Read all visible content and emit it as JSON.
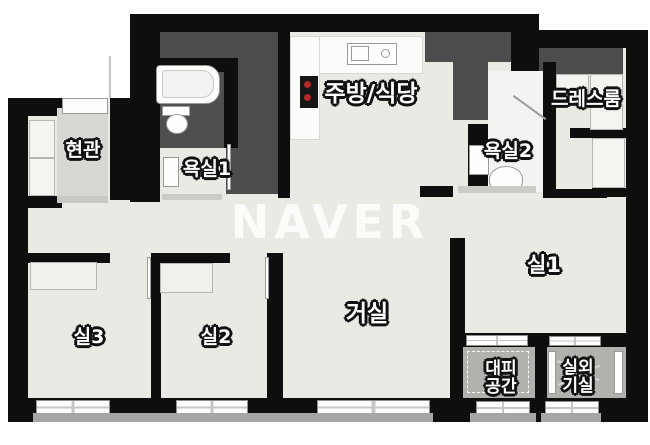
{
  "floorplan": {
    "watermark": "NAVER",
    "rooms": {
      "entrance": {
        "label": "현관"
      },
      "bath1": {
        "label": "욕실1"
      },
      "kitchen": {
        "label": "주방/식당"
      },
      "dressroom": {
        "label": "드레스룸"
      },
      "bath2": {
        "label": "욕실2"
      },
      "room1": {
        "label": "실1"
      },
      "living": {
        "label": "거실"
      },
      "room2": {
        "label": "실2"
      },
      "room3": {
        "label": "실3"
      },
      "evac": {
        "label": "대피 공간",
        "line1": "대피",
        "line2": "공간"
      },
      "outdoor": {
        "label": "실외 기실",
        "line1": "실외",
        "line2": "기실"
      }
    },
    "symbols": [
      "bathtub",
      "toilet",
      "washbasin",
      "kitchen-sink",
      "stove",
      "wardrobe",
      "shoe-closet",
      "window",
      "door"
    ],
    "colors": {
      "wall": "#0e0e0e",
      "floor": "#eae9e4",
      "service_zone": "#4c4c4c",
      "entrance_floor": "#d8d7d4",
      "balcony_floor": "#b2b1ae",
      "stove_burner": "#b3272a",
      "watermark": "rgba(255,255,255,0.82)"
    }
  }
}
